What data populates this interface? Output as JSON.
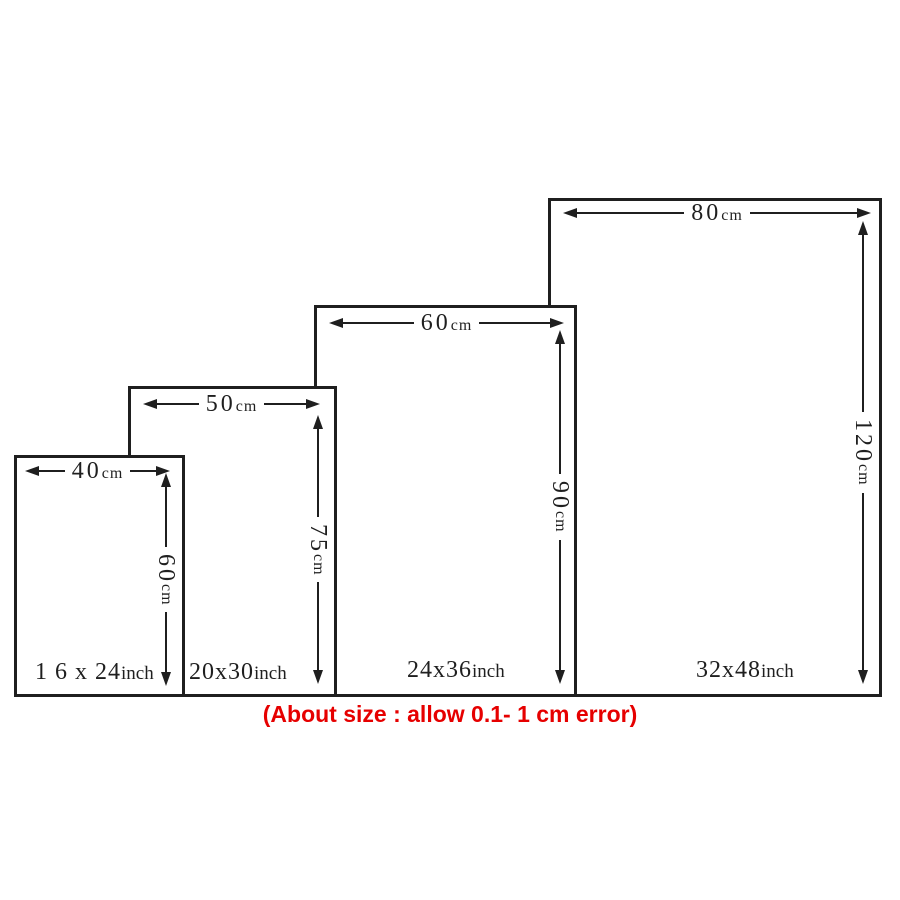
{
  "diagram": {
    "type": "size-chart",
    "line_color": "#1f1f1f",
    "background_color": "#ffffff",
    "note": {
      "text": "(About size : allow 0.1- 1 cm error)",
      "color": "#e60000"
    },
    "sizes": [
      {
        "label": {
          "value": "1 6 x 24",
          "unit": "inch"
        },
        "width": {
          "value": "40",
          "unit": "cm"
        },
        "height": {
          "value": "60",
          "unit": "cm"
        }
      },
      {
        "label": {
          "value": "20x30",
          "unit": "inch"
        },
        "width": {
          "value": "50",
          "unit": "cm"
        },
        "height": {
          "value": "75",
          "unit": "cm"
        }
      },
      {
        "label": {
          "value": "24x36",
          "unit": "inch"
        },
        "width": {
          "value": "60",
          "unit": "cm"
        },
        "height": {
          "value": "90",
          "unit": "cm"
        }
      },
      {
        "label": {
          "value": "32x48",
          "unit": "inch"
        },
        "width": {
          "value": "80",
          "unit": "cm"
        },
        "height": {
          "value": "120",
          "unit": "cm"
        }
      }
    ]
  }
}
